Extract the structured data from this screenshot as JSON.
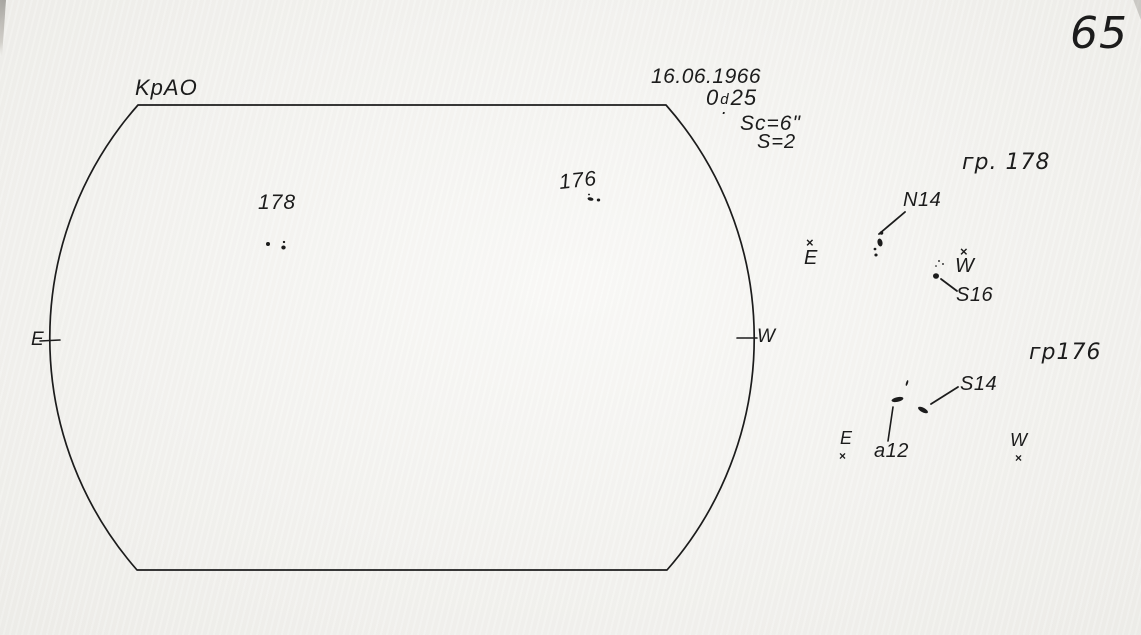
{
  "page_number": "65",
  "header": {
    "observatory": "KpAO",
    "date": "16.06.1966",
    "time_whole": "0",
    "time_sup": "d",
    "time_dot": ".",
    "time_frac": "25",
    "scale_note": "Sc=6\"",
    "seeing_note": "S=2"
  },
  "disk": {
    "east_label": "E",
    "west_label": "W",
    "group_labels": {
      "g178": "178",
      "g176": "176"
    }
  },
  "details": {
    "g178": {
      "title": "гр. 178",
      "north_spot": "N14",
      "south_spot": "S16",
      "east_label": "E",
      "west_label": "W",
      "marker": "×"
    },
    "g176": {
      "title": "гр176",
      "south_spot": "S14",
      "pore": "a12",
      "east_label": "E",
      "west_label": "W",
      "marker": "×"
    }
  },
  "drawing": {
    "ink_color": "#1c1c1c",
    "paper_color": "#f3f2ee",
    "disk_path": "M 138 105 L 666 105 A 352 352 0 0 1 667 570 L 137 570 A 352 352 0 0 1 138 105 Z",
    "lines": [
      {
        "x1": 40,
        "y1": 341,
        "x2": 60,
        "y2": 340,
        "w": 1.6
      },
      {
        "x1": 737,
        "y1": 338,
        "x2": 757,
        "y2": 338,
        "w": 1.6
      },
      {
        "x1": 905,
        "y1": 212,
        "x2": 879,
        "y2": 234,
        "w": 1.8
      },
      {
        "x1": 941,
        "y1": 279,
        "x2": 957,
        "y2": 291,
        "w": 1.8
      },
      {
        "x1": 931,
        "y1": 404,
        "x2": 958,
        "y2": 387,
        "w": 1.8
      },
      {
        "x1": 893,
        "y1": 407,
        "x2": 888,
        "y2": 441,
        "w": 1.6
      }
    ],
    "spots": [
      {
        "x": 268,
        "y": 244,
        "rx": 2.0,
        "ry": 2.0,
        "rot": 0
      },
      {
        "x": 284,
        "y": 242,
        "rx": 1.2,
        "ry": 1.1,
        "rot": 0
      },
      {
        "x": 283.5,
        "y": 247.5,
        "rx": 2.2,
        "ry": 2.0,
        "rot": 0
      },
      {
        "x": 589,
        "y": 194.5,
        "rx": 1.0,
        "ry": 0.9,
        "rot": 0
      },
      {
        "x": 590.5,
        "y": 199,
        "rx": 3.0,
        "ry": 1.7,
        "rot": 12
      },
      {
        "x": 598.5,
        "y": 200,
        "rx": 1.7,
        "ry": 1.5,
        "rot": 0
      },
      {
        "x": 881.5,
        "y": 233,
        "rx": 1.8,
        "ry": 1.7,
        "rot": 0
      },
      {
        "x": 880,
        "y": 242.5,
        "rx": 2.5,
        "ry": 4.0,
        "rot": -12
      },
      {
        "x": 875,
        "y": 249,
        "rx": 1.4,
        "ry": 1.3,
        "rot": 0
      },
      {
        "x": 876,
        "y": 255,
        "rx": 1.6,
        "ry": 1.5,
        "rot": 0
      },
      {
        "x": 939,
        "y": 261,
        "rx": 1.0,
        "ry": 0.9,
        "rot": 0
      },
      {
        "x": 943,
        "y": 264,
        "rx": 1.0,
        "ry": 0.9,
        "rot": 0
      },
      {
        "x": 936,
        "y": 266,
        "rx": 0.9,
        "ry": 0.8,
        "rot": 0
      },
      {
        "x": 936,
        "y": 276,
        "rx": 3.0,
        "ry": 2.8,
        "rot": 0
      },
      {
        "x": 907,
        "y": 383,
        "rx": 1.0,
        "ry": 3.0,
        "rot": 18
      },
      {
        "x": 897.5,
        "y": 399.5,
        "rx": 6.0,
        "ry": 2.3,
        "rot": -12
      },
      {
        "x": 923,
        "y": 410,
        "rx": 5.5,
        "ry": 2.3,
        "rot": 28
      }
    ]
  }
}
